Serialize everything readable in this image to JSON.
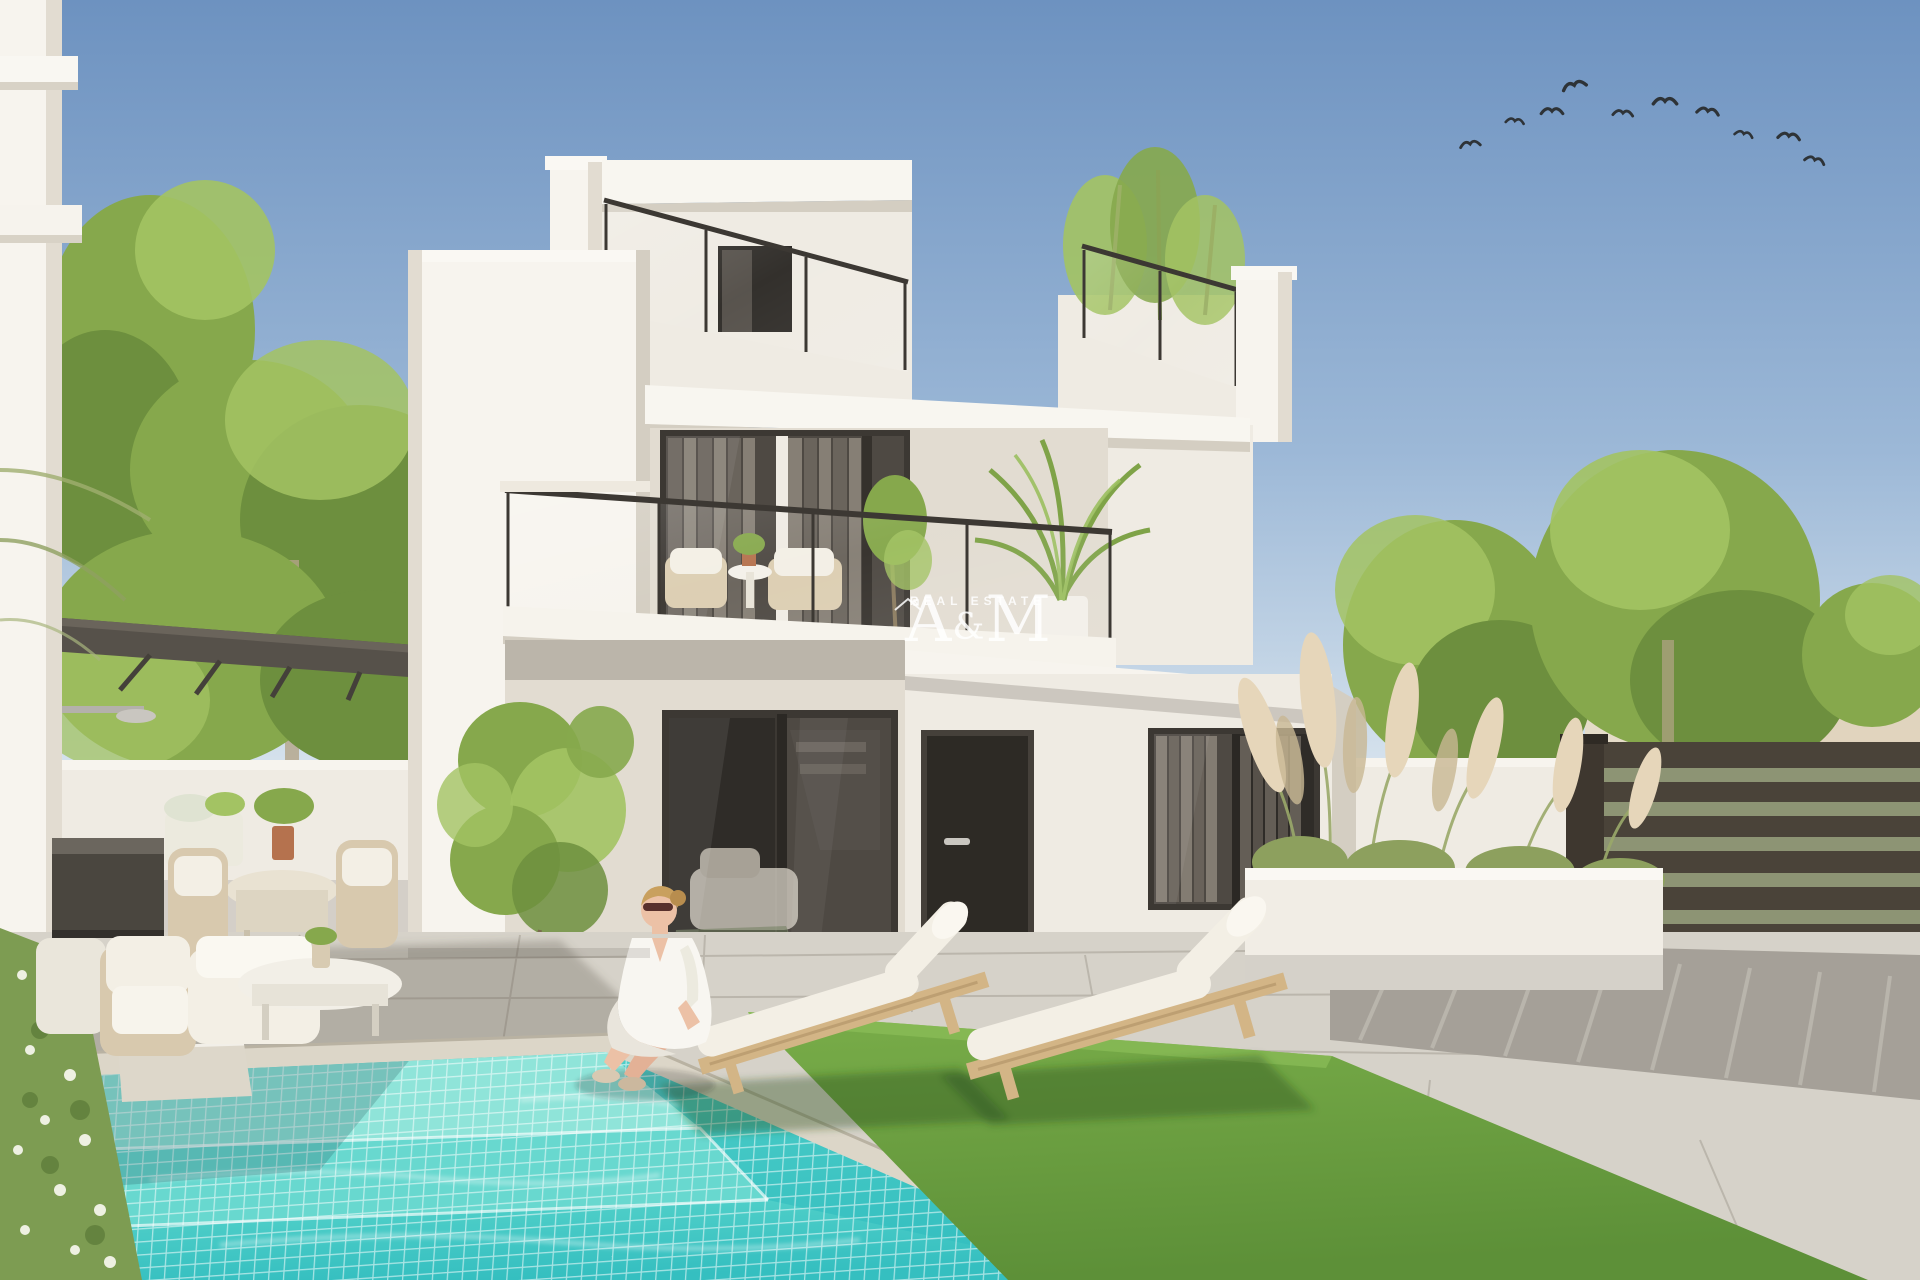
{
  "watermark": {
    "letter_a": "A",
    "ampersand": "&",
    "letter_m": "M",
    "tagline": "REAL ESTATE"
  },
  "scene": {
    "description": "Architectural render of a modern two-storey white villa with rooftop terrace, glass balcony, turquoise mosaic pool, two wooden sun loungers on artificial grass, garden lounge and dining furniture under a dark pergola, pampas-grass planter, slatted privacy fence and a woman in a white dress sitting at the pool edge",
    "objects": [
      "white modern villa",
      "rooftop terrace with glass railing",
      "first-floor balcony with wicker chairs",
      "palm plant on balcony",
      "bamboo on roof terrace",
      "dark framed sliding glass doors",
      "front door",
      "turquoise mosaic swimming pool with steps",
      "woman sitting at pool edge",
      "two wooden sun loungers",
      "artificial grass lawn",
      "outdoor lounge sofa set",
      "outdoor dining set with plant",
      "dark pergola",
      "outdoor shower",
      "storage bench",
      "climbing vine on wall",
      "pampas grass planter",
      "horizontal slatted privacy fence",
      "neighbouring houses with terracotta roofs",
      "green trees",
      "flock of birds in blue sky",
      "flowering hedge"
    ],
    "sky": {
      "birds_count": 10,
      "birds": [
        [
          1470,
          143,
          1.1,
          -8
        ],
        [
          1515,
          120,
          1.0,
          6
        ],
        [
          1552,
          110,
          1.2,
          0
        ],
        [
          1574,
          84,
          1.3,
          -14
        ],
        [
          1623,
          112,
          1.1,
          4
        ],
        [
          1665,
          100,
          1.3,
          0
        ],
        [
          1708,
          110,
          1.2,
          8
        ],
        [
          1744,
          133,
          1.0,
          12
        ],
        [
          1789,
          135,
          1.2,
          6
        ],
        [
          1815,
          159,
          1.1,
          14
        ]
      ]
    }
  },
  "colors": {
    "sky-top": "#6d92c0",
    "sky-mid": "#9cb8d7",
    "sky-horizon": "#dfe9f0",
    "bird": "#2e3337",
    "tree-dark": "#6d8f3e",
    "tree-mid": "#86a84c",
    "tree-light": "#a3c363",
    "trunk": "#b3a488",
    "wall-bright": "#f7f4ee",
    "wall-white": "#efebe3",
    "wall-shade": "#e2dcd1",
    "wall-deep": "#d4cec2",
    "frame-dark": "#3c3833",
    "glass-dark": "#4e4943",
    "glass-deep": "#2f2c28",
    "curtain-light": "#8d857b",
    "curtain-dark": "#6e675f",
    "door-front": "#2d2a25",
    "pergola": "#56514a",
    "pergola-dark": "#44403a",
    "tile": "#d6d2c9",
    "tile-joint": "#b5b0a6",
    "gravel": "#a5a098",
    "coping": "#dcd6c8",
    "water-step": "#8fe4d9",
    "water-mid": "#55d2ca",
    "water-deep": "#35bfc0",
    "water-grid": "#ffffff",
    "grass-light": "#79ad49",
    "grass-dark": "#5d9038",
    "lounger-wood": "#d3b586",
    "cushion": "#f3efe5",
    "fence": "#4a4339",
    "fence-gap": "#8d9474",
    "house-far-wall": "#e7dcc8",
    "house-far-roof": "#b8845c",
    "planter": "#f1ede5",
    "pampas": "#e6d6ba",
    "hedge": "#7d9c52",
    "skin": "#ecc1a6",
    "hair": "#c9a05e",
    "dress": "#f8f6f1",
    "watermark": "#ffffff"
  }
}
